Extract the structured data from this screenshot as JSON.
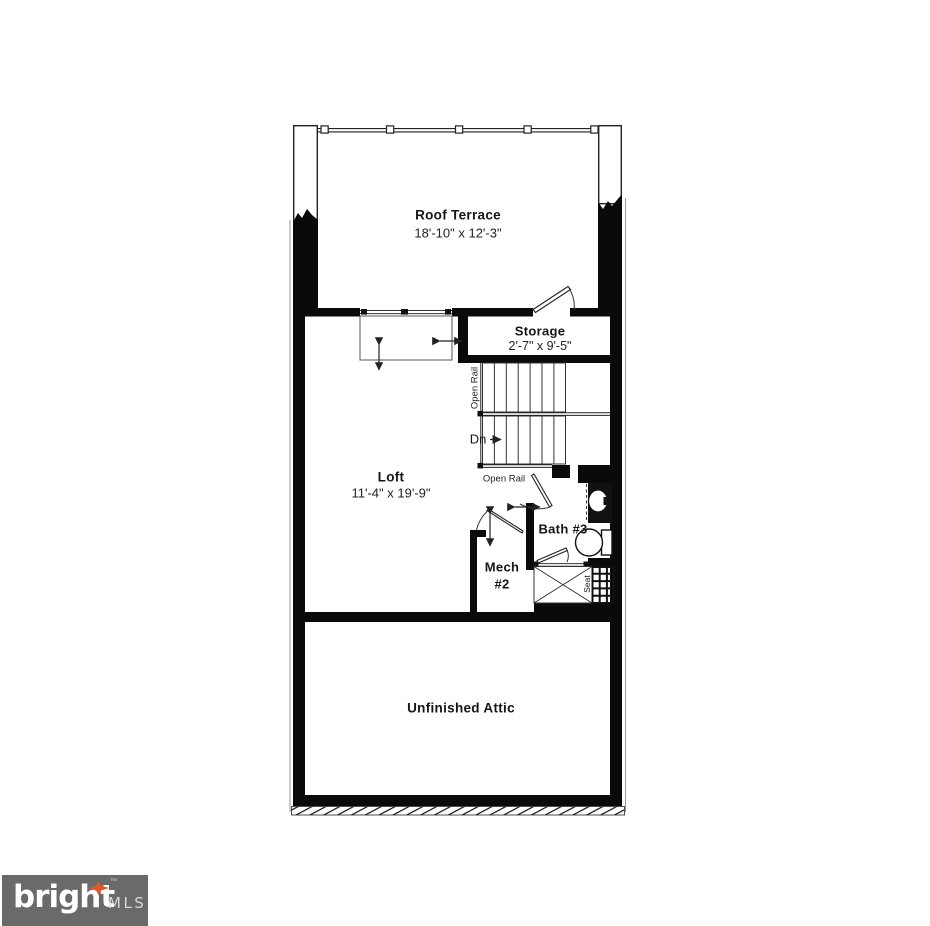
{
  "floorplan": {
    "rooms": {
      "roof_terrace": {
        "name": "Roof Terrace",
        "dims": "18'-10\" x 12'-3\""
      },
      "storage": {
        "name": "Storage",
        "dims": "2'-7\" x 9'-5\""
      },
      "loft": {
        "name": "Loft",
        "dims": "11'-4\" x 19'-9\""
      },
      "bath_3": {
        "name": "Bath #3"
      },
      "mech_2": {
        "name": "Mech",
        "number": "#2"
      },
      "unfinished_attic": {
        "name": "Unfinished Attic"
      }
    },
    "stairs": {
      "down_label": "Dn",
      "open_rail_vertical": "Open Rail",
      "open_rail_horizontal": "Open Rail"
    },
    "fixtures": {
      "shower_seat": "Seat"
    },
    "colors": {
      "wall": "#0a0a0a",
      "line": "#333333",
      "background": "#ffffff",
      "logo_background": "#6a6a6a",
      "logo_text": "#ffffff",
      "logo_mls": "#d9d9d9",
      "logo_accent": "#e0572e"
    }
  },
  "branding": {
    "name": "bright",
    "suffix": "MLS",
    "trademark": "™"
  }
}
